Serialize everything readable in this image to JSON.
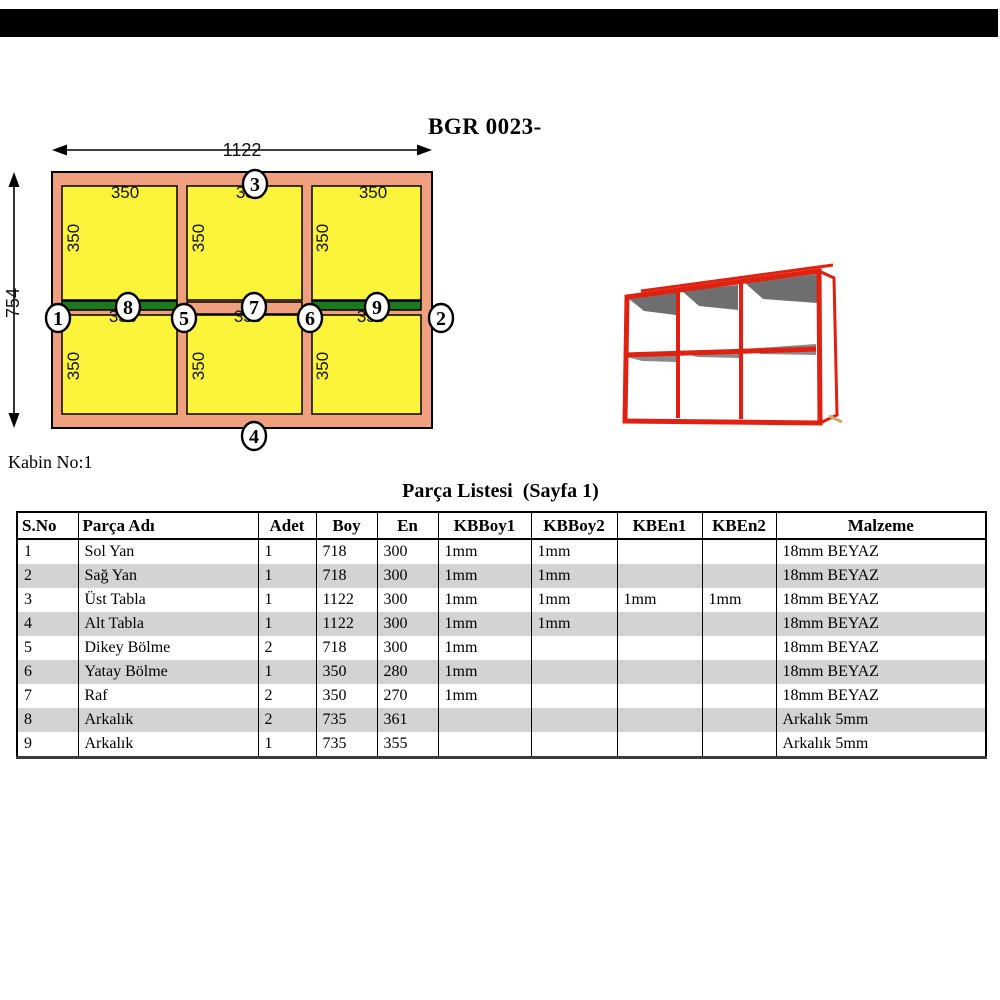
{
  "colors": {
    "bar_black": "#000000",
    "frame_salmon": "#F0A07E",
    "cell_yellow": "#FBF43B",
    "shelf_green": "#1E781E",
    "render_red": "#E02010",
    "row_gray": "#D3D3D3"
  },
  "title": "BGR 0023-",
  "cabin_label": "Kabin No:1",
  "diagram": {
    "width_dim": "1122",
    "height_dim": "754",
    "cell_dim": "350",
    "markers": [
      "1",
      "2",
      "3",
      "4",
      "5",
      "6",
      "7",
      "8",
      "9"
    ]
  },
  "parts_list": {
    "title": "Parça Listesi  (Sayfa 1)",
    "columns": [
      "S.No",
      "Parça Adı",
      "Adet",
      "Boy",
      "En",
      "KBBoy1",
      "KBBoy2",
      "KBEn1",
      "KBEn2",
      "Malzeme"
    ],
    "rows": [
      [
        "1",
        "Sol Yan",
        "1",
        "718",
        "300",
        "1mm",
        "1mm",
        "",
        "",
        "18mm BEYAZ"
      ],
      [
        "2",
        "Sağ Yan",
        "1",
        "718",
        "300",
        "1mm",
        "1mm",
        "",
        "",
        "18mm BEYAZ"
      ],
      [
        "3",
        "Üst Tabla",
        "1",
        "1122",
        "300",
        "1mm",
        "1mm",
        "1mm",
        "1mm",
        "18mm BEYAZ"
      ],
      [
        "4",
        "Alt Tabla",
        "1",
        "1122",
        "300",
        "1mm",
        "1mm",
        "",
        "",
        "18mm BEYAZ"
      ],
      [
        "5",
        "Dikey Bölme",
        "2",
        "718",
        "300",
        "1mm",
        "",
        "",
        "",
        "18mm BEYAZ"
      ],
      [
        "6",
        "Yatay Bölme",
        "1",
        "350",
        "280",
        "1mm",
        "",
        "",
        "",
        "18mm BEYAZ"
      ],
      [
        "7",
        "Raf",
        "2",
        "350",
        "270",
        "1mm",
        "",
        "",
        "",
        "18mm BEYAZ"
      ],
      [
        "8",
        "Arkalık",
        "2",
        "735",
        "361",
        "",
        "",
        "",
        "",
        "Arkalık 5mm"
      ],
      [
        "9",
        "Arkalık",
        "1",
        "735",
        "355",
        "",
        "",
        "",
        "",
        "Arkalık 5mm"
      ]
    ]
  }
}
